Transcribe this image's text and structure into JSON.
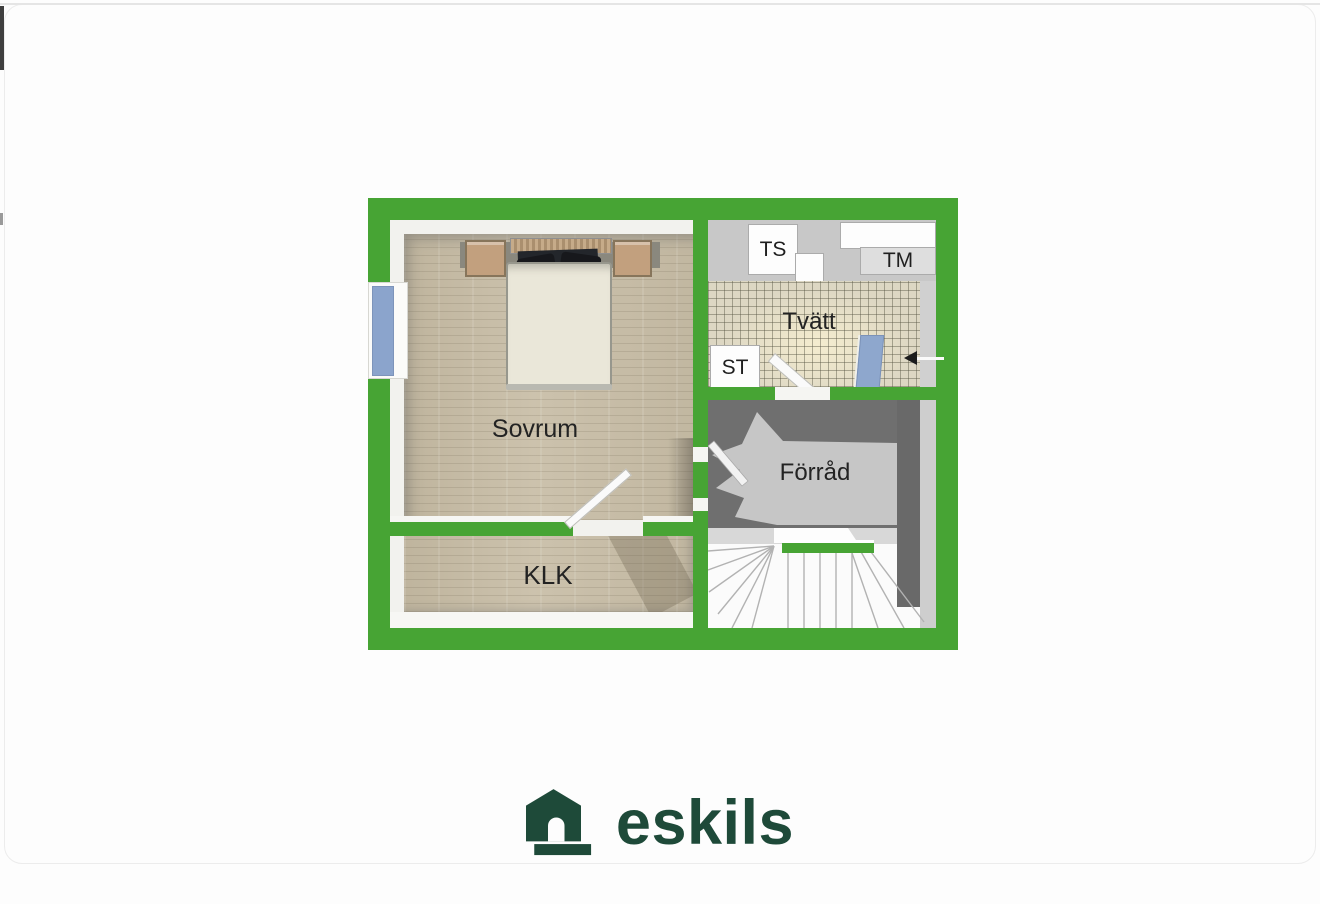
{
  "floor_plan": {
    "rooms": {
      "sovrum": "Sovrum",
      "klk": "KLK",
      "tvatt": "Tvätt",
      "forrad": "Förråd"
    },
    "fixtures": {
      "drying_cabinet": "TS",
      "washing_machine": "TM",
      "cleaning_cabinet": "ST"
    },
    "colors": {
      "wall_green": "#47a434",
      "wood_floor": "#cbc1ac",
      "tile_floor": "#ddd7c3",
      "storage_dark": "#6f6f6f",
      "storage_light": "#c6c6c6",
      "window_blue": "#8ba4cc"
    }
  },
  "brand": {
    "name": "eskils",
    "color": "#1e4a39"
  }
}
